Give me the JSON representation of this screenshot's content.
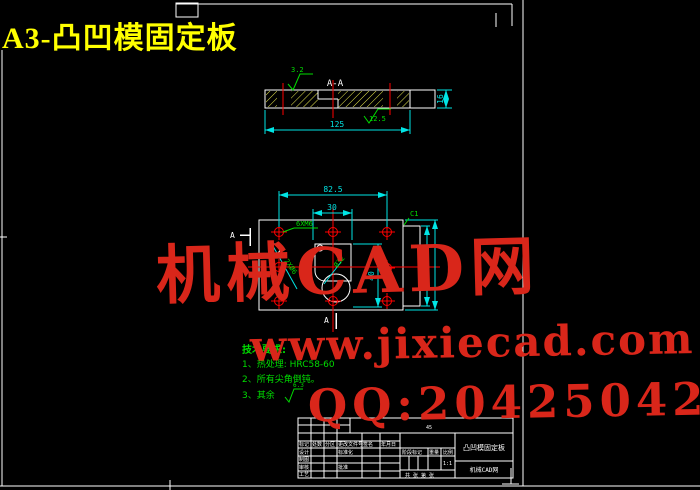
{
  "drawing_title": "A3-凸凹模固定板",
  "watermark": {
    "site": "机械CAD网",
    "url": "www.jixiecad.com",
    "qq": "QQ:20425042"
  },
  "section_view": {
    "label": "A-A",
    "dim_length": "125",
    "dim_thickness": "16",
    "roughness_top": "3.2",
    "roughness_bottom": "12.5"
  },
  "plan_view": {
    "dim_width": "82.5",
    "dim_slot_width": "30",
    "dim_slot_height": "40",
    "chamfer": "C1",
    "tapped_holes": "6XM6",
    "dowel_holes": "2XØ6",
    "bore": "Ø32",
    "section_mark": "A"
  },
  "tech_requirements": {
    "heading": "技术要求:",
    "item1": "1、热处理: HRC58-60",
    "item2": "2、所有尖角倒钝。",
    "item3": "3、其余",
    "item3_roughness": "6.3"
  },
  "title_block": {
    "part_name": "凸凹模固定板",
    "org": "机械CAD网",
    "material": "45",
    "col_mark": "标记",
    "col_count": "处数",
    "col_zone": "分区",
    "col_docno": "更改文件号",
    "col_sign": "签名",
    "col_date": "年月日",
    "row_design": "设计",
    "row_standard": "标准化",
    "row_draft": "制图",
    "row_check": "审核",
    "row_approve": "批准",
    "row_process": "工艺",
    "stage": "阶段标记",
    "weight": "重量",
    "scale": "比例",
    "scale_value": "1:1",
    "sheet": "共 张 第 张"
  }
}
